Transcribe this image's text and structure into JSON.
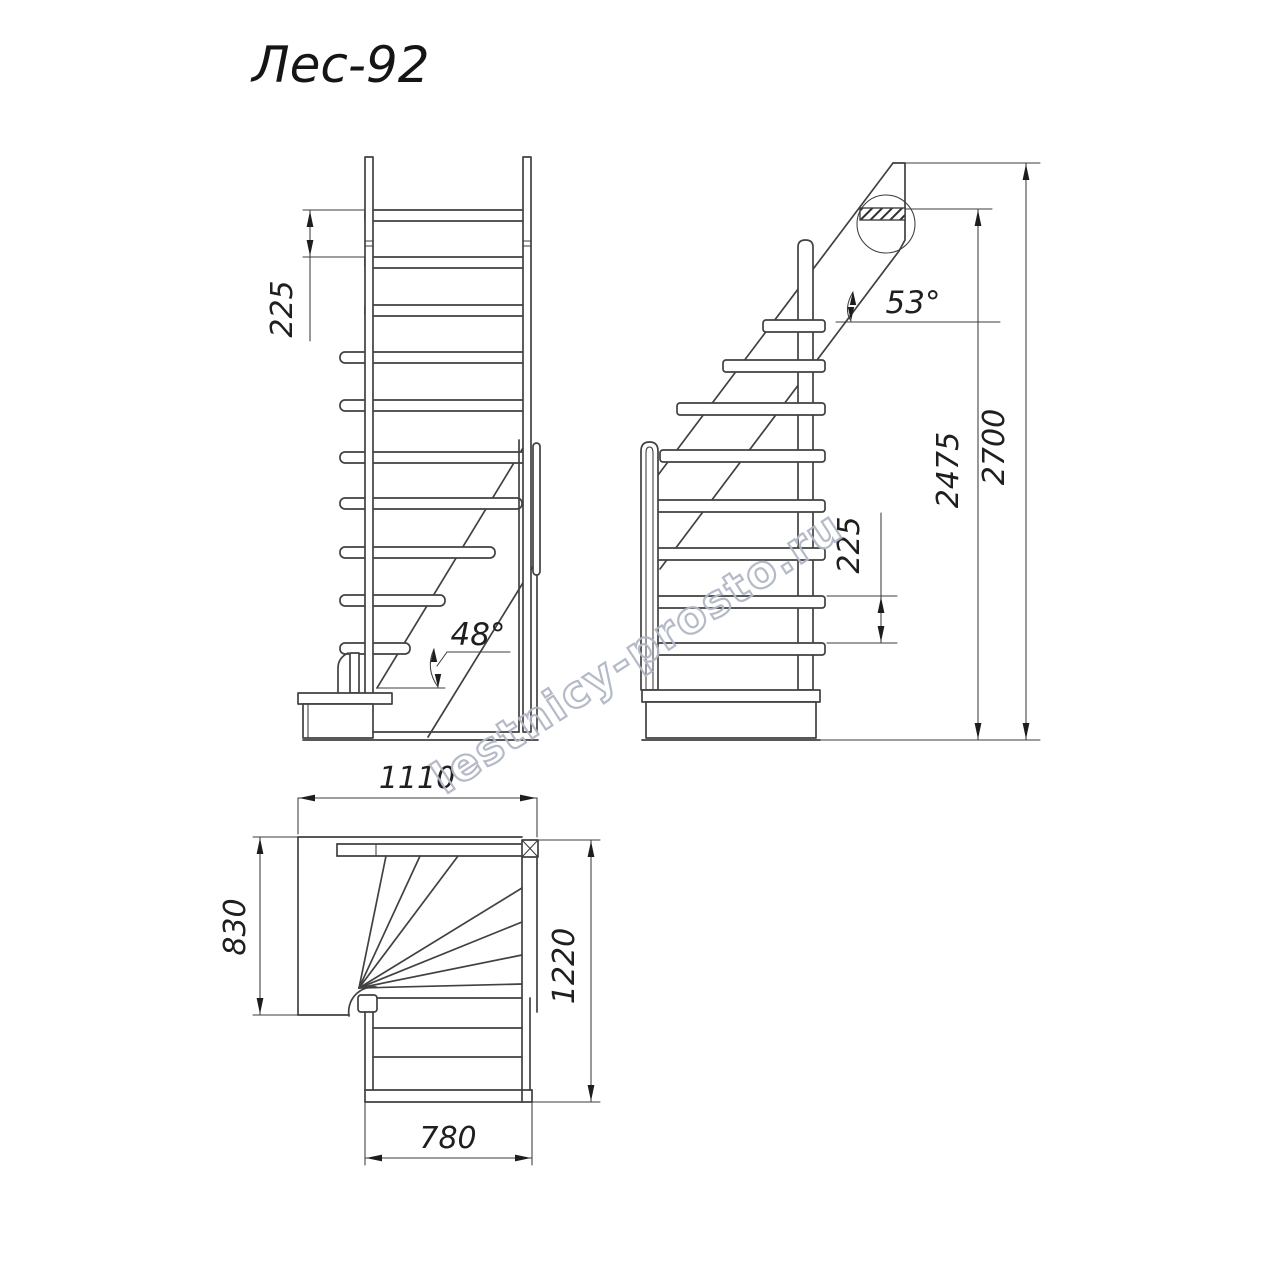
{
  "title": "Лес-92",
  "watermark": "lestnicy-prosto.ru",
  "front_view": {
    "riser_height": "225",
    "stringer_angle": "48°"
  },
  "side_view": {
    "riser_height": "225",
    "stringer_angle": "53°",
    "floor_to_ceiling": "2475",
    "total_rise": "2700"
  },
  "plan_view": {
    "overall_width": "1110",
    "landing_depth": "830",
    "overall_depth": "1220",
    "flight_width": "780"
  },
  "colors": {
    "line": "#414141",
    "dim_text": "#1f1f1f",
    "watermark": "#b2b7c6",
    "hatch": "#2f2f2f",
    "background": "#ffffff"
  }
}
